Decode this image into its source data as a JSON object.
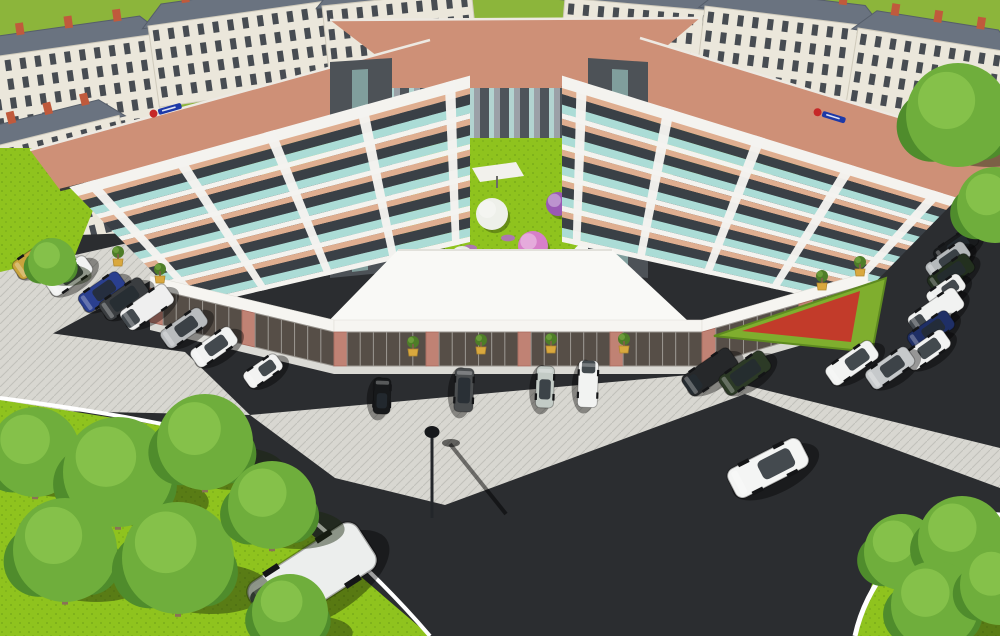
{
  "scene": {
    "description": "Aerial 3D architectural rendering of a V-shaped five-storey residential complex with ground-floor retail arcade, central courtyard garden, surface parking lots, roads and landscaped lawns"
  },
  "palette": {
    "field": "#8CB53B",
    "lawn": "#8FC31E",
    "asphalt": "#2B2D30",
    "pavement": "#D8D7D1",
    "sidewalk": "#DBDAD5",
    "curb": "#FFFFFF",
    "roof": "#CE9077",
    "roofEdge": "#EDE9E2",
    "bgWall": "#EBE7DB",
    "bgRoof": "#6A7380",
    "chimney": "#C05A3C",
    "facadeWhite": "#F4F3EF",
    "peach": "#DFAE90",
    "teal": "#ABDCD6",
    "windowDark": "#3A4046",
    "towerGray": "#4D5257",
    "pierGray": "#9BA1A7",
    "retailGlass": "#564E47",
    "brick": "#C08274",
    "fascia": "#F6F5F1",
    "hedge": "#7FAE2E",
    "flowerRed": "#C23B2A",
    "potYellow": "#D9A83E",
    "potPlant": "#4E7D28",
    "treeDark": "#4F8C2C",
    "treeMid": "#6FAE3C",
    "treeLight": "#85C14A",
    "trunk": "#8A7256",
    "umbrella": "#F2F1EC",
    "lampMetal": "#23262A"
  },
  "background_buildings": [
    {
      "x": -15,
      "y": 58,
      "w": 175,
      "h": 92,
      "a": -8
    },
    {
      "x": 148,
      "y": 26,
      "w": 185,
      "h": 82,
      "a": -8
    },
    {
      "x": 322,
      "y": 6,
      "w": 150,
      "h": 66,
      "a": -6
    },
    {
      "x": 565,
      "y": -2,
      "w": 165,
      "h": 68,
      "a": 5
    },
    {
      "x": 705,
      "y": 6,
      "w": 175,
      "h": 76,
      "a": 7
    },
    {
      "x": 858,
      "y": 28,
      "w": 155,
      "h": 92,
      "a": 9
    },
    {
      "x": -12,
      "y": 148,
      "w": 135,
      "h": 125,
      "a": -14
    }
  ],
  "complex": {
    "floors": 5,
    "strip_sequence": [
      [
        "peach",
        0.2
      ],
      [
        "window",
        0.34
      ],
      [
        "teal",
        0.28
      ],
      [
        "white",
        0.18
      ]
    ],
    "facades": [
      {
        "name": "left-wing-facade",
        "top": [
          [
            78,
            196
          ],
          [
            470,
            88
          ]
        ],
        "bottom": [
          [
            188,
            308
          ],
          [
            470,
            242
          ]
        ],
        "piers": [
          0.05,
          0.27,
          0.5,
          0.73,
          0.95
        ]
      },
      {
        "name": "right-wing-facade",
        "top": [
          [
            562,
            88
          ],
          [
            950,
            206
          ]
        ],
        "bottom": [
          [
            562,
            242
          ],
          [
            852,
            306
          ]
        ],
        "piers": [
          0.05,
          0.27,
          0.5,
          0.73,
          0.95
        ]
      }
    ],
    "retail": {
      "path": [
        [
          150,
          288
        ],
        [
          334,
          332
        ],
        [
          702,
          332
        ],
        [
          868,
          284
        ]
      ],
      "height": 34,
      "fascia": 12,
      "panel": 13,
      "brick_every": 7
    },
    "signs": [
      {
        "side": "left",
        "x": 166,
        "y": 110,
        "rot": -16
      },
      {
        "side": "right",
        "x": 830,
        "y": 116,
        "rot": 17
      }
    ],
    "sign_colors": {
      "dot": "#C62828",
      "bar": "#1D39A8"
    }
  },
  "courtyard": {
    "blossom_trees": [
      {
        "x": 448,
        "y": 186,
        "r": 14,
        "c": "#C03028"
      },
      {
        "x": 492,
        "y": 214,
        "r": 16,
        "c": "#EEF0EA"
      },
      {
        "x": 533,
        "y": 246,
        "r": 15,
        "c": "#D77FC9"
      },
      {
        "x": 558,
        "y": 204,
        "r": 12,
        "c": "#9A5AB5"
      },
      {
        "x": 586,
        "y": 257,
        "r": 14,
        "c": "#F0F1EC"
      },
      {
        "x": 432,
        "y": 172,
        "r": 10,
        "c": "#B22D25"
      },
      {
        "x": 462,
        "y": 258,
        "r": 12,
        "c": "#E8EAE4"
      }
    ],
    "flower_patches": [
      [
        470,
        248
      ],
      [
        500,
        260
      ],
      [
        528,
        270
      ],
      [
        508,
        238
      ],
      [
        545,
        253
      ],
      [
        480,
        272
      ]
    ],
    "umbrella": {
      "x": 494,
      "y": 173
    }
  },
  "flowerbed": {
    "hedge_points": "714,336 886,278 872,352",
    "inner_points": "742,331 860,291 851,342"
  },
  "planter_pots": [
    [
      118,
      262
    ],
    [
      160,
      279
    ],
    [
      413,
      352
    ],
    [
      481,
      350
    ],
    [
      551,
      349
    ],
    [
      624,
      349
    ],
    [
      822,
      286
    ],
    [
      860,
      272
    ]
  ],
  "street_lamp": {
    "x": 432,
    "y": 432,
    "pole_h": 84
  },
  "cars": [
    {
      "x": 36,
      "y": 259,
      "a": -35,
      "s": 1.1,
      "c": "#C9A33C",
      "t": "sedan"
    },
    {
      "x": 69,
      "y": 276,
      "a": -35,
      "s": 1.1,
      "c": "#F1F2F1",
      "t": "sedan"
    },
    {
      "x": 102,
      "y": 292,
      "a": -35,
      "s": 1.1,
      "c": "#2A3F8F",
      "t": "sedan"
    },
    {
      "x": 124,
      "y": 299,
      "a": -35,
      "s": 1.1,
      "c": "#3A3D40",
      "t": "suv"
    },
    {
      "x": 147,
      "y": 307,
      "a": -35,
      "s": 1.05,
      "c": "#EFEFEF",
      "t": "van"
    },
    {
      "x": 184,
      "y": 328,
      "a": -35,
      "s": 1.1,
      "c": "#B9BCBE",
      "t": "sedan"
    },
    {
      "x": 214,
      "y": 347,
      "a": -35,
      "s": 1.1,
      "c": "#F1F2F1",
      "t": "sedan"
    },
    {
      "x": 263,
      "y": 371,
      "a": -35,
      "s": 1.05,
      "c": "#F3F3F2",
      "t": "hatch"
    },
    {
      "x": 382,
      "y": 396,
      "a": 92,
      "s": 0.95,
      "c": "#17191B",
      "t": "hatch"
    },
    {
      "x": 464,
      "y": 390,
      "a": 92,
      "s": 0.95,
      "c": "#4A4D4F",
      "t": "suv"
    },
    {
      "x": 545,
      "y": 387,
      "a": 92,
      "s": 0.95,
      "c": "#C3CBC6",
      "t": "sedan"
    },
    {
      "x": 588,
      "y": 384,
      "a": 92,
      "s": 0.9,
      "c": "#F2F3F2",
      "t": "van"
    },
    {
      "x": 956,
      "y": 247,
      "a": -35,
      "s": 1.05,
      "c": "#191B1D",
      "t": "sedan"
    },
    {
      "x": 948,
      "y": 261,
      "a": -35,
      "s": 1.05,
      "c": "#B5B9BB",
      "t": "sedan"
    },
    {
      "x": 951,
      "y": 274,
      "a": -35,
      "s": 1.05,
      "c": "#23301F",
      "t": "suv"
    },
    {
      "x": 946,
      "y": 291,
      "a": -35,
      "s": 1.05,
      "c": "#EFF0EF",
      "t": "hatch"
    },
    {
      "x": 936,
      "y": 312,
      "a": -35,
      "s": 1.1,
      "c": "#F1F2F1",
      "t": "van"
    },
    {
      "x": 931,
      "y": 331,
      "a": -35,
      "s": 1.1,
      "c": "#1F2F66",
      "t": "sedan"
    },
    {
      "x": 927,
      "y": 350,
      "a": -35,
      "s": 1.1,
      "c": "#F2F3F2",
      "t": "sedan"
    },
    {
      "x": 852,
      "y": 363,
      "a": -35,
      "s": 1.15,
      "c": "#F2F3F2",
      "t": "wagon"
    },
    {
      "x": 890,
      "y": 368,
      "a": -35,
      "s": 1.15,
      "c": "#C6C9CB",
      "t": "sedan"
    },
    {
      "x": 710,
      "y": 372,
      "a": -35,
      "s": 1.1,
      "c": "#26282A",
      "t": "van"
    },
    {
      "x": 745,
      "y": 373,
      "a": -35,
      "s": 1.15,
      "c": "#2C3A26",
      "t": "suv"
    },
    {
      "x": 312,
      "y": 576,
      "a": -33,
      "s": 2.5,
      "c": "#ECEEED",
      "t": "van"
    },
    {
      "x": 768,
      "y": 468,
      "a": -27,
      "s": 1.7,
      "c": "#F4F5F4",
      "t": "wagon"
    }
  ],
  "trees": [
    {
      "x": 52,
      "y": 262,
      "r": 24,
      "trunk": false
    },
    {
      "x": 958,
      "y": 115,
      "r": 52,
      "trunk": false
    },
    {
      "x": 995,
      "y": 205,
      "r": 38,
      "trunk": false
    },
    {
      "x": 35,
      "y": 452,
      "r": 45,
      "trunk": true
    },
    {
      "x": 118,
      "y": 472,
      "r": 55,
      "trunk": true
    },
    {
      "x": 205,
      "y": 442,
      "r": 48,
      "trunk": true
    },
    {
      "x": 65,
      "y": 550,
      "r": 52,
      "trunk": true
    },
    {
      "x": 178,
      "y": 558,
      "r": 56,
      "trunk": true
    },
    {
      "x": 272,
      "y": 505,
      "r": 44,
      "trunk": true
    },
    {
      "x": 290,
      "y": 612,
      "r": 38,
      "trunk": false
    },
    {
      "x": 902,
      "y": 552,
      "r": 38,
      "trunk": true
    },
    {
      "x": 962,
      "y": 540,
      "r": 44,
      "trunk": true
    },
    {
      "x": 935,
      "y": 605,
      "r": 44,
      "trunk": false
    },
    {
      "x": 1000,
      "y": 585,
      "r": 40,
      "trunk": false
    }
  ]
}
